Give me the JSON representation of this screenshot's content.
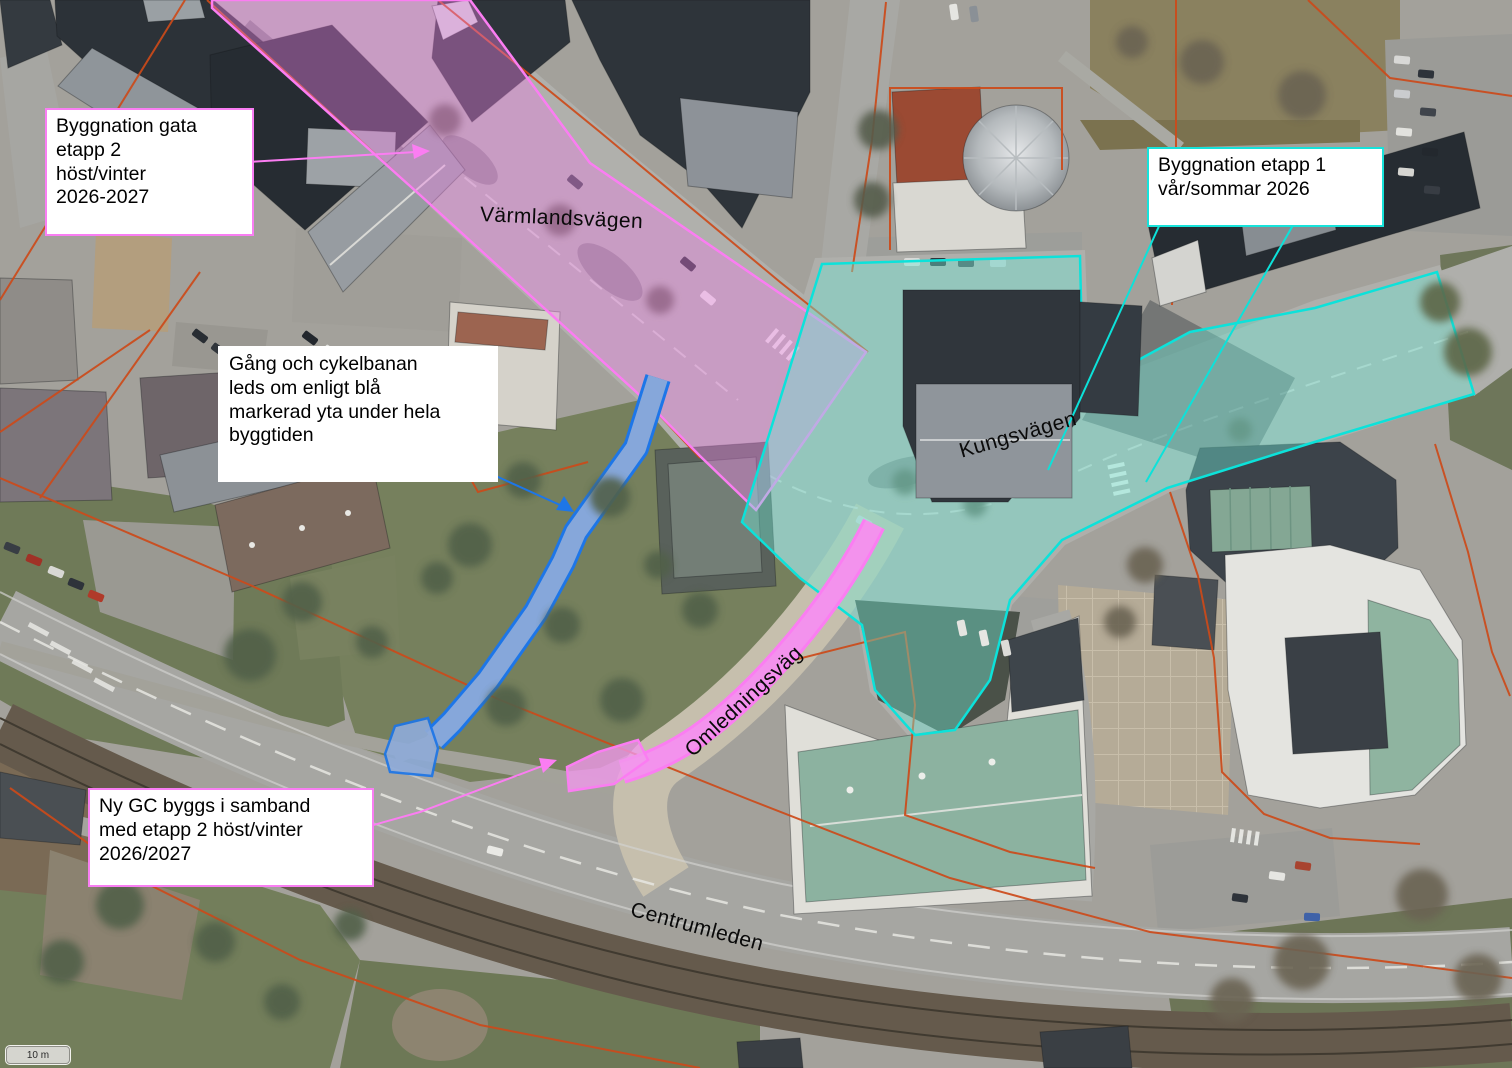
{
  "map": {
    "scale_bar": {
      "label": "10 m"
    },
    "road_labels": {
      "varmlandsvagen": "Värmlandsvägen",
      "kungsvagen": "Kungsvägen",
      "omledningsvag": "Omledningsväg",
      "centrumleden": "Centrumleden"
    },
    "annotations": {
      "etapp2": {
        "lines": [
          "Byggnation gata",
          "etapp 2",
          "höst/vinter",
          "2026-2027"
        ],
        "border_color": "#f97ef3"
      },
      "gc_detour": {
        "lines": [
          "Gång och cykelbanan",
          "leds om enligt blå",
          "markerad yta under hela",
          "byggtiden"
        ],
        "border_color": "#ffffff"
      },
      "etapp1": {
        "lines": [
          "Byggnation etapp 1",
          "vår/sommar 2026"
        ],
        "border_color": "#17e2da"
      },
      "ny_gc": {
        "lines": [
          "Ny GC byggs i samband",
          "med etapp 2 höst/vinter",
          "2026/2027"
        ],
        "border_color": "#f97ef3"
      }
    },
    "overlays": {
      "etapp2_area": {
        "fill": "rgba(238,128,230,0.40)",
        "stroke": "#fb7df2"
      },
      "etapp1_area": {
        "fill": "rgba(112,230,212,0.42)",
        "stroke": "#0ce2da"
      },
      "gc_detour_area": {
        "fill": "#8fabd8",
        "stroke": "#1d76e8"
      },
      "ny_gc_area": {
        "fill": "rgba(241,152,236,0.78)",
        "stroke": "#fb7df2"
      }
    },
    "cadastral_color": "#cc4a1a"
  }
}
